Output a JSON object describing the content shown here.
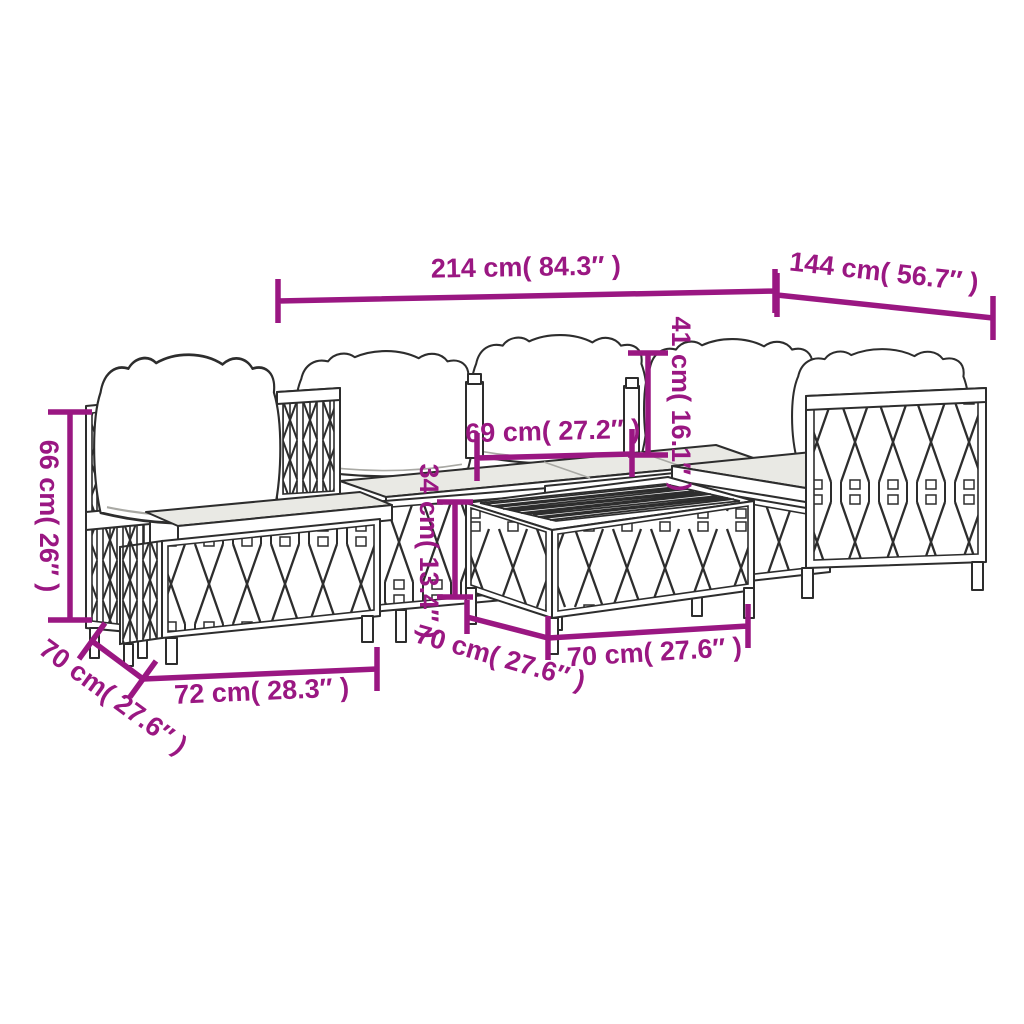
{
  "diagram": {
    "type": "furniture-dimension-line-drawing",
    "subject": "6 piece garden lounge set with cushions",
    "accent_color": "#9A1782",
    "line_color": "#2D2D2D",
    "cushion_shade": "#E9E9E4",
    "background": "#FFFFFF"
  },
  "dims": {
    "sofa_total_width": "214 cm( 84.3″ )",
    "sofa_total_depth": "144 cm( 56.7″ )",
    "backrest_total_height": "66 cm( 26″ )",
    "cushion_back_height": "41 cm( 16.1″ )",
    "seat_inner_width": "69 cm( 27.2″ )",
    "table_height": "34 cm( 13.4″ )",
    "chair_seat_depth": "70 cm( 27.6″ )",
    "chair_seat_width": "72 cm( 28.3″ )",
    "table_depth": "70 cm( 27.6″ )",
    "table_width": "70 cm( 27.6″ )"
  }
}
